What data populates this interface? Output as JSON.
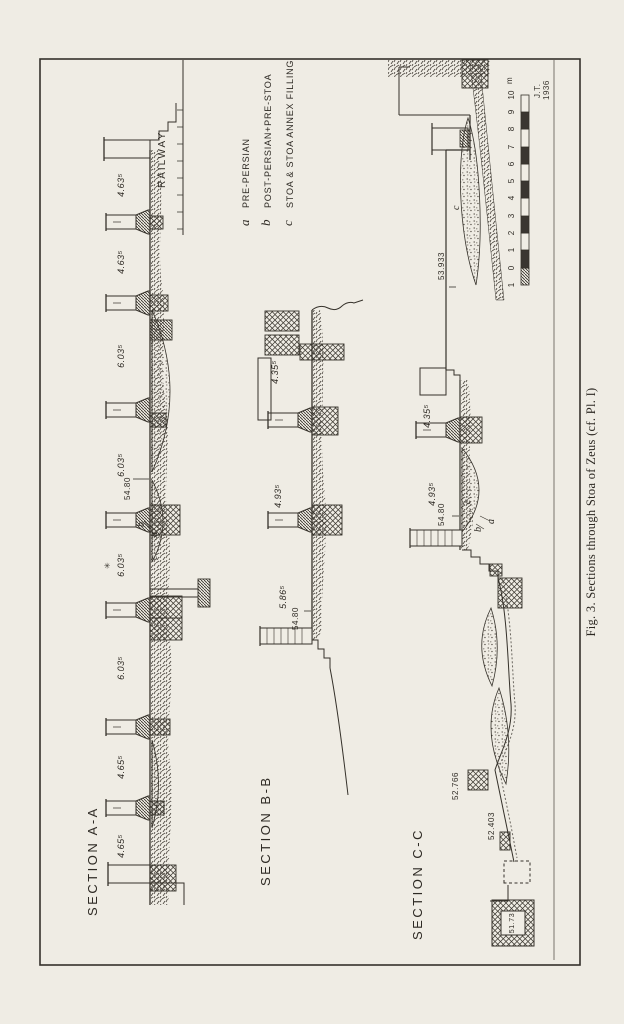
{
  "figure": {
    "caption": "Fig. 3.  Sections through Stoa of Zeus (cf. Pl. I)",
    "credit": [
      "J.T.",
      "1936"
    ]
  },
  "legend": {
    "items": [
      {
        "key": "a",
        "label": "PRE-PERSIAN"
      },
      {
        "key": "b",
        "label": "POST-PERSIAN+PRE-STOA"
      },
      {
        "key": "c",
        "label": "STOA & STOA ANNEX FILLING"
      }
    ]
  },
  "scale_bar": {
    "unit": "m",
    "ticks": [
      "1",
      "0",
      "1",
      "2",
      "3",
      "4",
      "5",
      "6",
      "7",
      "8",
      "9",
      "10"
    ]
  },
  "sections": {
    "aa": {
      "title": "SECTION A-A",
      "railway": "RAILWAY",
      "spacings": [
        "4.65⁵",
        "4.65⁵",
        "6.03⁵",
        "6.03⁵",
        "6.03⁵",
        "6.03⁵",
        "4.63⁵",
        "4.63⁵"
      ],
      "level": "54.80",
      "letters": [
        "b",
        "a",
        "c"
      ],
      "plant": "✳"
    },
    "bb": {
      "title": "SECTION B-B",
      "dims": [
        "4.35⁵",
        "4.93⁵",
        "5.86⁵"
      ],
      "level": "54.80"
    },
    "cc": {
      "title": "SECTION C-C",
      "fill_letter": "c",
      "dims": [
        "4.35⁵",
        "4.93⁵"
      ],
      "level": "54.80",
      "letters": [
        "c",
        "b",
        "a"
      ],
      "elevations": [
        "53.933",
        "52.766",
        "52.403",
        "51.73"
      ]
    }
  }
}
